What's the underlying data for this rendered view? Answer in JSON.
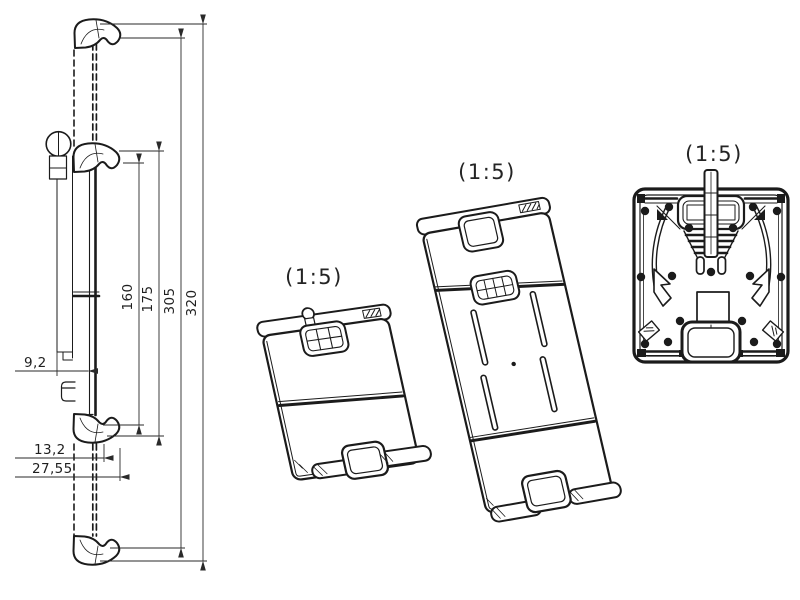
{
  "colors": {
    "background": "#ffffff",
    "line": "#1b1b1b"
  },
  "side_view": {
    "vertical_dims": [
      "160",
      "175",
      "305",
      "320"
    ],
    "horizontal_dims": [
      "9,2",
      "13,2",
      "27,55"
    ]
  },
  "iso_front_view": {
    "scale_label": "(1:5)"
  },
  "iso_extended_view": {
    "scale_label": "(1:5)"
  },
  "rear_view": {
    "scale_label": "(1:5)"
  }
}
